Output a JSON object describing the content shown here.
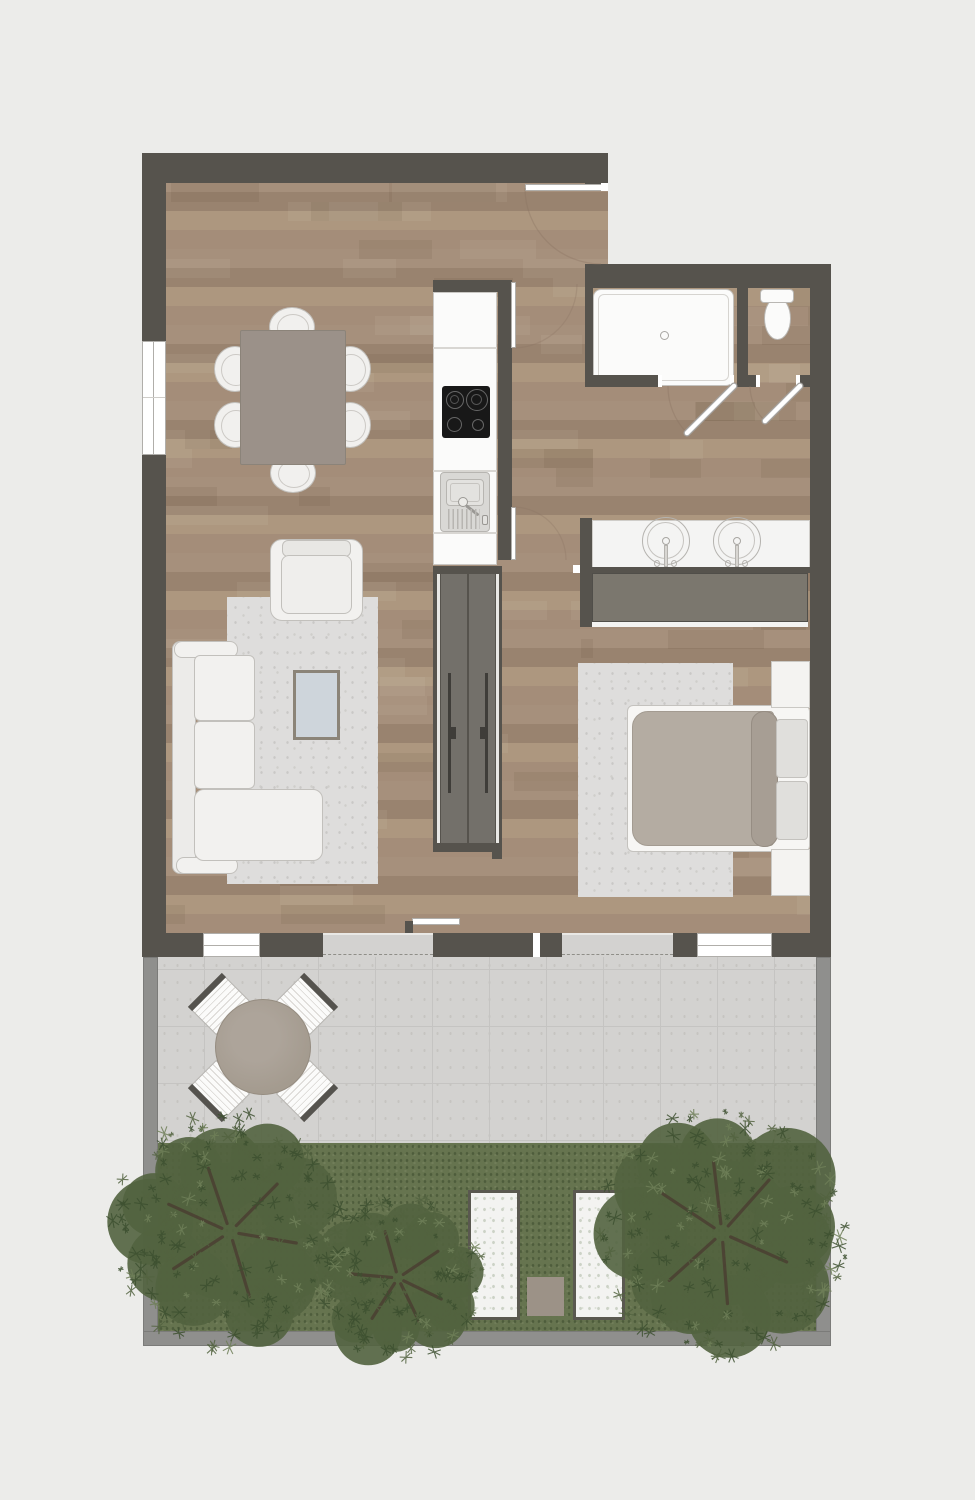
{
  "meta": {
    "title": "apartment-floor-plan-top-view",
    "canvas_width": 975,
    "canvas_height": 1500
  },
  "palette": {
    "background": "#ececea",
    "wall": "#56534d",
    "wood_a": "#a48d79",
    "wood_b": "#ad977f",
    "wood_c": "#99836f",
    "wood_d": "#a6907c",
    "rug": "#dedddc",
    "tile": "#d3d2d0",
    "tile_joint": "#c5c4c2",
    "boundary": "#8f8f8d",
    "grass": "#66744f",
    "leaf_dark": "#3d5030",
    "leaf_mid": "#52633f",
    "leaf_light": "#6f7f58",
    "branch": "#4a3c31",
    "panel": "#73706a",
    "wardrobe": "#7b776e",
    "duvet": "#b4aca2",
    "bed_roll": "#a79e94",
    "cooktop": "#181818",
    "gravel": "#f3f3f1",
    "paver": "#9c9287",
    "table_taupe": "#9b9189",
    "glass_table": "#ced5db",
    "patio_table": "#a49b8f"
  },
  "plan": {
    "rooms": [
      {
        "name": "living-dining-room",
        "fixtures": [
          "dining-table",
          "dining-chairs-x6",
          "sofa-l-shaped",
          "armchair",
          "coffee-table",
          "area-rug",
          "window-left",
          "terrace-glass-door"
        ]
      },
      {
        "name": "kitchen",
        "fixtures": [
          "tall-cabinet",
          "cooktop-4-burners",
          "sink-with-drainboard",
          "counter"
        ]
      },
      {
        "name": "entry-hall",
        "fixtures": [
          "entry-door",
          "hallway-doors-x2",
          "sliding-door-unit-2-panels"
        ]
      },
      {
        "name": "shower-room",
        "fixtures": [
          "walk-in-shower-tray",
          "swing-door"
        ]
      },
      {
        "name": "wc",
        "fixtures": [
          "toilet",
          "swing-door"
        ]
      },
      {
        "name": "bathroom",
        "fixtures": [
          "double-vanity-2-round-sinks",
          "wardrobe"
        ]
      },
      {
        "name": "bedroom",
        "fixtures": [
          "double-bed",
          "pillows-x2",
          "nightstands-x2",
          "area-rug",
          "terrace-glass-door",
          "window"
        ]
      },
      {
        "name": "terrace",
        "fixtures": [
          "round-patio-table",
          "patio-chairs-x4",
          "stone-tile-paving"
        ]
      },
      {
        "name": "garden",
        "fixtures": [
          "lawn",
          "trees-x3",
          "gravel-beds-x2",
          "paver-square",
          "boundary-wall"
        ]
      }
    ]
  },
  "garden": {
    "trees": [
      {
        "cx": 230,
        "cy": 1232,
        "r": 112,
        "seed": 7
      },
      {
        "cx": 398,
        "cy": 1278,
        "r": 80,
        "seed": 13
      },
      {
        "cx": 722,
        "cy": 1233,
        "r": 118,
        "seed": 29
      }
    ]
  }
}
